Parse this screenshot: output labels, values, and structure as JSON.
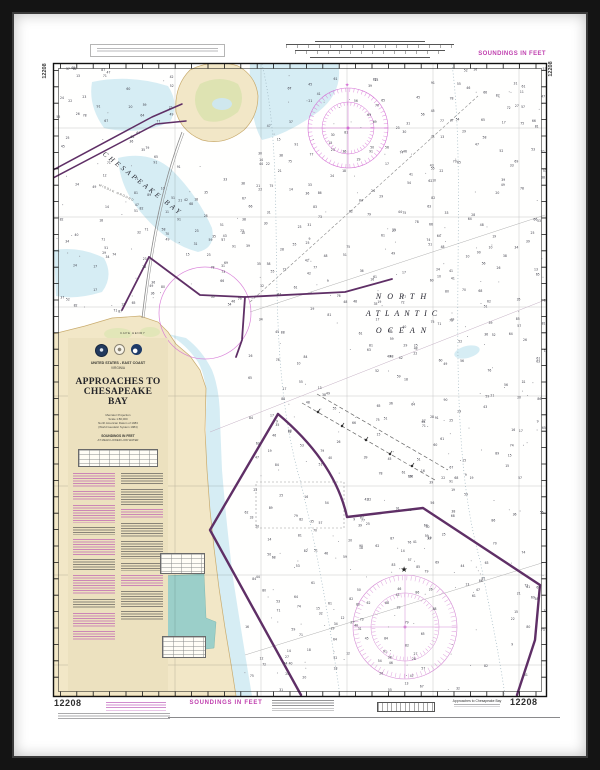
{
  "chart": {
    "number": "12208",
    "title": "Approaches to Chesapeake Bay"
  },
  "margin_top": {
    "soundings_label": "SOUNDINGS IN FEET",
    "chart_number_left": "12208",
    "chart_number_right": "12208"
  },
  "margin_bottom": {
    "chart_number_left": "12208",
    "chart_number_right": "12208",
    "soundings_label": "SOUNDINGS IN FEET",
    "title_small": "Approaches to Chesapeake Bay"
  },
  "title_block": {
    "nation": "UNITED STATES - EAST COAST",
    "state": "VIRGINIA",
    "title_line1": "APPROACHES TO",
    "title_line2": "CHESAPEAKE BAY",
    "projection": "Mercator Projection",
    "scale": "Scale 1:80,000",
    "datum": "North American Datum of 1983",
    "datum_sub": "(World Geodetic System 1984)",
    "soundings": "SOUNDINGS IN FEET",
    "soundings_sub": "AT MEAN LOWER LOW WATER"
  },
  "map_labels": {
    "bay": "CHESAPEAKE BAY",
    "shoal": "MIDDLE GROUND",
    "ocean_line1": "NORTH",
    "ocean_line2": "ATLANTIC",
    "ocean_line3": "OCEAN",
    "cape": "CAPE HENRY"
  },
  "colors": {
    "frame": "#141414",
    "magenta": "#bf3fae",
    "magenta_light": "#d46fd4",
    "purple": "#5f2f66",
    "land": "#f2e7c7",
    "shallow": "#d6edf4",
    "lake": "#9bcfc9",
    "panel": "#ece1bf"
  },
  "soundings_texture": {
    "seed": 13,
    "count": 760,
    "dots": 240,
    "min": 9,
    "max": 92
  }
}
